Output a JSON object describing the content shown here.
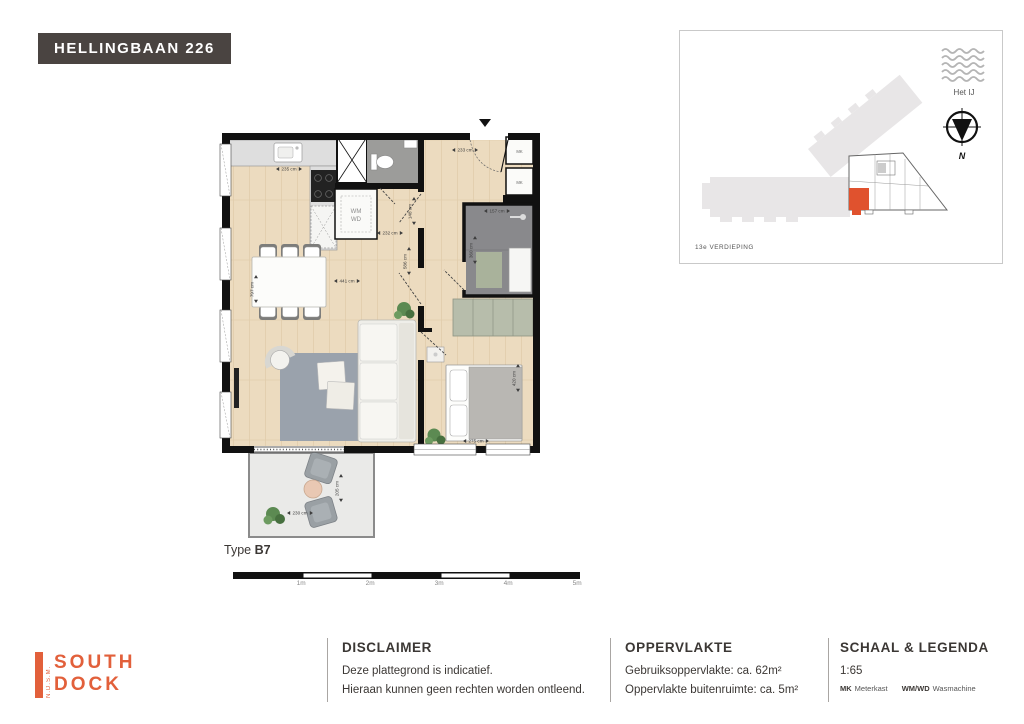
{
  "badge": {
    "title": "HELLINGBAAN 226"
  },
  "plan": {
    "type_label": "Type",
    "type_value": "B7",
    "labels": {
      "mk1": "MK",
      "mk2": "MK",
      "wm": "WM",
      "wd": "WD"
    },
    "dims": {
      "kitchen_w": "235 cm",
      "entry_w": "233 cm",
      "hall_w": "148 cm",
      "wm_w": "232 cm",
      "hall_l": "586 cm",
      "living_w": "441 cm",
      "living_l": "797 cm",
      "bath_w": "157 cm",
      "bath_l": "360 cm",
      "bedroom_w": "275 cm",
      "bedroom_l": "420 cm",
      "balcony_w": "230 cm",
      "balcony_l": "205 cm"
    }
  },
  "scalebar": {
    "labels": [
      "1m",
      "2m",
      "3m",
      "4m",
      "5m"
    ]
  },
  "sitemap": {
    "water_label": "Het IJ",
    "compass_n": "N",
    "floor_label": "13e VERDIEPING"
  },
  "footer": {
    "logo": {
      "side": "N.D.S.M.",
      "top": "SOUTH",
      "bottom": "DOCK"
    },
    "disclaimer": {
      "title": "DISCLAIMER",
      "line1": "Deze plattegrond is indicatief.",
      "line2": "Hieraan kunnen geen rechten worden ontleend."
    },
    "area": {
      "title": "OPPERVLAKTE",
      "row1_label": "Gebruiksoppervlakte:",
      "row1_value": "ca. 62m²",
      "row2_label": "Oppervlakte buitenruimte:",
      "row2_value": "ca. 5m²"
    },
    "legend": {
      "title": "SCHAAL & LEGENDA",
      "scale": "1:65",
      "items": [
        {
          "abbr": "MK",
          "label": "Meterkast"
        },
        {
          "abbr": "WM/WD",
          "label": "Wasmachine"
        }
      ]
    }
  },
  "colors": {
    "accent": "#e2603b",
    "unit_highlight": "#e0522e",
    "badge_bg": "#4a4441",
    "wood": "#ecdbbf",
    "bath": "#89898c",
    "rug": "#9aa2ac"
  }
}
